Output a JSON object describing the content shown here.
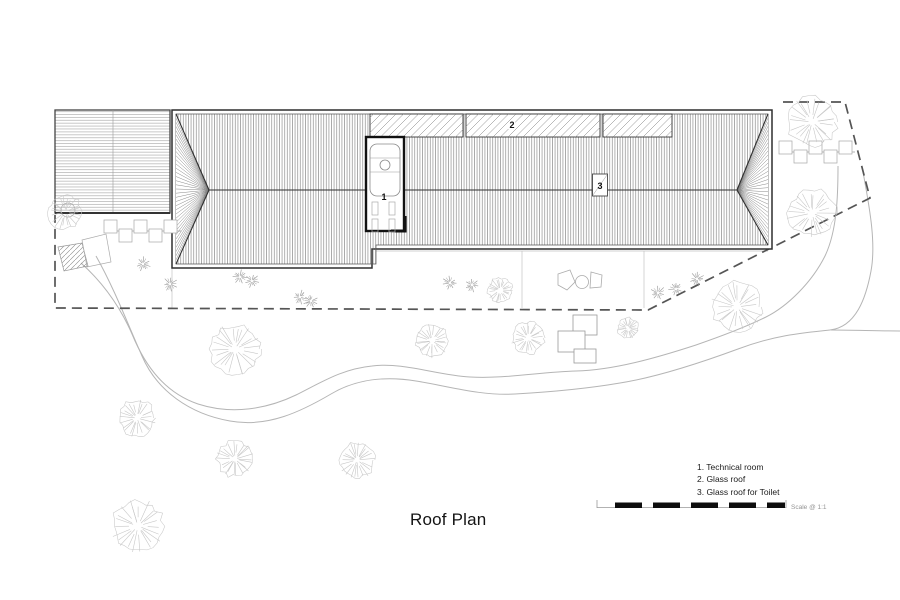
{
  "title": "Roof Plan",
  "legend": {
    "items": [
      "1. Technical room",
      "2. Glass roof",
      "3. Glass roof for Toilet"
    ]
  },
  "scale_bar": {
    "label": "Scale @ 1:1"
  },
  "plan_labels": {
    "technical_room": "1",
    "glass_roof": "2",
    "toilet_glass_roof": "3"
  },
  "colors": {
    "line_dark": "#2f2f2f",
    "roof_hatch": "#6e6e6e",
    "left_roof_hatch": "#8f8f8f",
    "glass_hatch": "#777777",
    "boundary": "#555555",
    "site_light": "#b5b5b5",
    "tree": "#c7c7c7",
    "plant": "#9c9c9c",
    "background": "#ffffff"
  },
  "site": {
    "trees": [
      {
        "x": 65,
        "y": 212,
        "r": 18
      },
      {
        "x": 812,
        "y": 122,
        "r": 26
      },
      {
        "x": 812,
        "y": 213,
        "r": 25
      },
      {
        "x": 737,
        "y": 307,
        "r": 26
      },
      {
        "x": 628,
        "y": 328,
        "r": 11
      },
      {
        "x": 235,
        "y": 349,
        "r": 26
      },
      {
        "x": 432,
        "y": 341,
        "r": 17
      },
      {
        "x": 528,
        "y": 338,
        "r": 17
      },
      {
        "x": 500,
        "y": 290,
        "r": 13
      },
      {
        "x": 137,
        "y": 418,
        "r": 19
      },
      {
        "x": 235,
        "y": 459,
        "r": 19
      },
      {
        "x": 357,
        "y": 460,
        "r": 19
      },
      {
        "x": 138,
        "y": 526,
        "r": 27
      }
    ],
    "plants": [
      [
        143,
        264
      ],
      [
        170,
        284
      ],
      [
        240,
        277
      ],
      [
        252,
        281
      ],
      [
        300,
        297
      ],
      [
        311,
        301
      ],
      [
        450,
        283
      ],
      [
        472,
        285
      ],
      [
        658,
        293
      ],
      [
        676,
        289
      ],
      [
        697,
        279
      ]
    ],
    "crenellation_walls": [
      {
        "x1": 104,
        "x2": 181,
        "y": 231,
        "size": 13
      },
      {
        "x1": 779,
        "x2": 855,
        "y": 152,
        "size": 13
      }
    ]
  }
}
